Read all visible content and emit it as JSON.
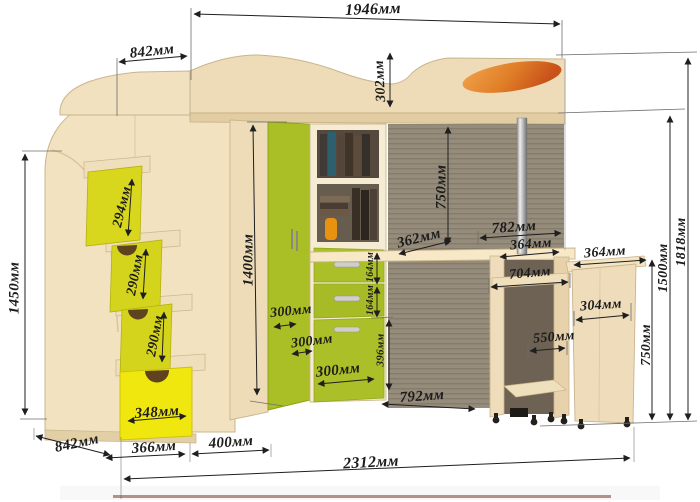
{
  "diagram": {
    "kind": "furniture-dimension-drawing",
    "subject": "loft bed with corner stairs, wardrobe, shelf column, pull-out desk and rolling cabinet",
    "units": "мм"
  },
  "colors": {
    "wood_light": "#f2e2c0",
    "wood_mid": "#e7d2a8",
    "accent_green": "#a9bf25",
    "accent_yellow_green": "#d8d71e",
    "accent_yellow": "#f0e70e",
    "recess_dark": "#968c7c",
    "pillow_orange": "#e07f28",
    "dimension_line": "#222222"
  },
  "dimensions": {
    "top_width_total": {
      "label": "1946мм"
    },
    "top_width_left": {
      "label": "842мм"
    },
    "headboard_height": {
      "label": "302мм"
    },
    "stairs_height": {
      "label": "1450мм"
    },
    "step_1": {
      "label": "294мм"
    },
    "step_2": {
      "label": "290мм"
    },
    "step_3": {
      "label": "290мм"
    },
    "stair_drawer_width": {
      "label": "348мм"
    },
    "stairs_depth": {
      "label": "842мм"
    },
    "base_left": {
      "label": "366мм"
    },
    "base_wardrobe": {
      "label": "400мм"
    },
    "base_total": {
      "label": "2312мм"
    },
    "wardrobe_height": {
      "label": "1400мм"
    },
    "wardrobe_depth_1": {
      "label": "300мм"
    },
    "wardrobe_depth_2": {
      "label": "300мм"
    },
    "wardrobe_depth_3": {
      "label": "300мм"
    },
    "drawer_height_1": {
      "label": "164мм"
    },
    "drawer_height_2": {
      "label": "164мм"
    },
    "drawer_bottom_height": {
      "label": "396мм"
    },
    "underbed_clearance": {
      "label": "750мм"
    },
    "desk_depth": {
      "label": "362мм"
    },
    "floor_gap": {
      "label": "792мм"
    },
    "desk_width_top": {
      "label": "782мм"
    },
    "desk_width_right": {
      "label": "364мм"
    },
    "desk_width_inner": {
      "label": "704мм"
    },
    "cabinet_top_width": {
      "label": "364мм"
    },
    "cabinet_width": {
      "label": "304мм"
    },
    "cabinet_depth": {
      "label": "550мм"
    },
    "desk_height": {
      "label": "750мм"
    },
    "bed_platform_height": {
      "label": "1500мм"
    },
    "total_height": {
      "label": "1818мм"
    }
  }
}
